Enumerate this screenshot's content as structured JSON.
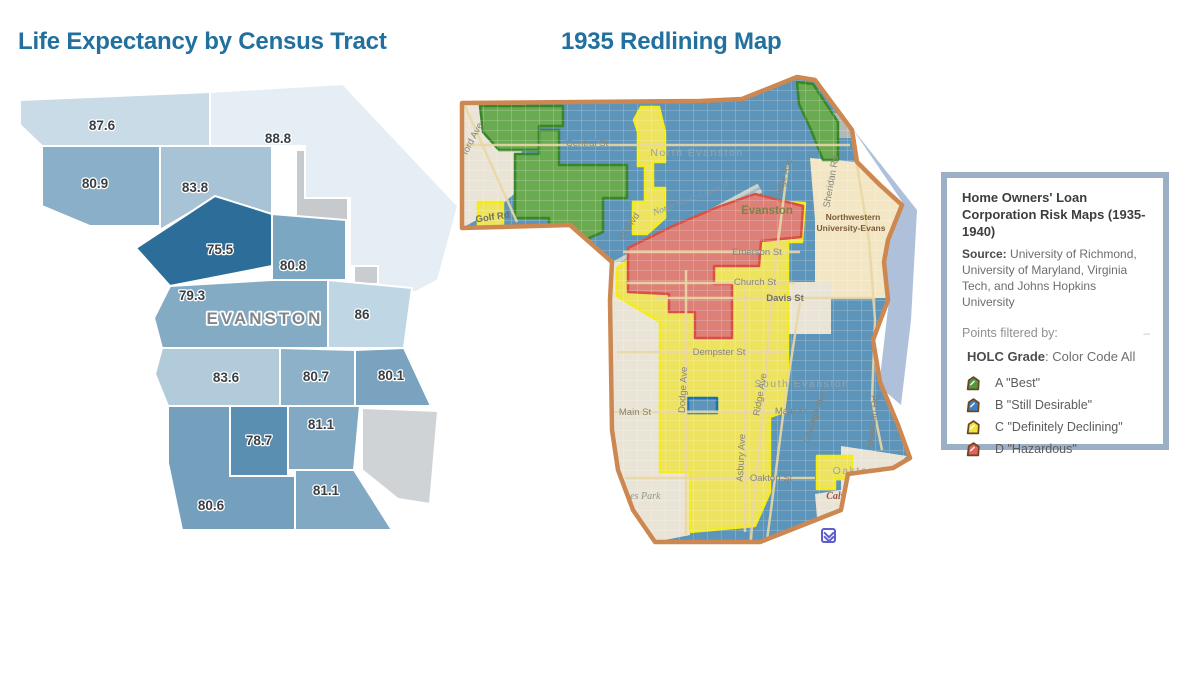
{
  "titles": {
    "left": "Life Expectancy by Census Tract",
    "right": "1935 Redlining Map",
    "color": "#21709e"
  },
  "life_map": {
    "city_label": "EVANSTON",
    "label_color": "#3a3f44",
    "tracts": [
      {
        "value": "87.6",
        "fill": "#c9dbe7",
        "points": "10,22 200,14 200,68 32,68 10,47",
        "lx": 92,
        "ly": 52
      },
      {
        "value": "88.8",
        "fill": "#e5eef4",
        "points": "200,14 333,6 448,128 428,202 406,214 368,214 368,188 340,188 340,120 295,120 295,68 200,68",
        "lx": 268,
        "ly": 65
      },
      {
        "value": "80.9",
        "fill": "#8aafc8",
        "points": "32,68 150,68 150,148 80,148 32,128",
        "lx": 85,
        "ly": 110
      },
      {
        "value": "83.8",
        "fill": "#a7c3d5",
        "points": "150,68 262,68 262,136 205,120 150,152",
        "lx": 185,
        "ly": 114
      },
      {
        "value": "75.5",
        "fill": "#2c6e99",
        "points": "126,170 205,118 262,136 262,188 160,208",
        "lx": 210,
        "ly": 176
      },
      {
        "value": "80.8",
        "fill": "#7ca7c2",
        "points": "262,136 336,142 336,202 262,202",
        "lx": 283,
        "ly": 192
      },
      {
        "value": "79.3",
        "fill": "#84abc4",
        "points": "160,208 262,202 318,202 318,270 152,270 144,240",
        "lx": 182,
        "ly": 222
      },
      {
        "value": "86",
        "fill": "#bfd7e4",
        "points": "318,202 402,210 394,270 318,270",
        "lx": 352,
        "ly": 241
      },
      {
        "value": "83.6",
        "fill": "#b2cbdb",
        "points": "152,270 270,270 270,328 158,328 145,296",
        "lx": 216,
        "ly": 304
      },
      {
        "value": "80.7",
        "fill": "#8db1c9",
        "points": "270,270 345,272 345,328 270,328",
        "lx": 306,
        "ly": 303
      },
      {
        "value": "80.1",
        "fill": "#79a3bf",
        "points": "345,272 394,270 421,328 345,328",
        "lx": 381,
        "ly": 302
      },
      {
        "value": "78.7",
        "fill": "#5a8fb2",
        "points": "220,328 278,328 278,398 220,398",
        "lx": 249,
        "ly": 367
      },
      {
        "value": "81.1",
        "fill": "#82a9c4",
        "points": "278,328 350,328 344,392 278,392",
        "lx": 311,
        "ly": 351
      },
      {
        "value": "80.6",
        "fill": "#74a0bd",
        "points": "158,328 220,328 220,398 285,398 285,452 172,452 158,385",
        "lx": 201,
        "ly": 432
      },
      {
        "value": "81.1",
        "fill": "#82a9c4",
        "points": "285,392 344,392 382,452 285,452",
        "lx": 316,
        "ly": 417
      }
    ],
    "unlabeled": [
      {
        "name": "campus-gray-west",
        "fill": "#c6cacd",
        "points": "286,72 338,72 338,176 286,176"
      },
      {
        "name": "campus-gray-east",
        "fill": "#c9cdd0",
        "points": "344,98 416,100 421,180 402,206 344,206"
      },
      {
        "name": "southeast-gray",
        "fill": "#d0d3d5",
        "points": "352,330 428,333 420,426 388,421 352,392"
      }
    ]
  },
  "redlining_map": {
    "boundary_points": "7,33 245,31 287,29 342,7 360,10 397,60 402,92 425,115 447,135 433,170 429,192 433,230 418,270 425,312 443,355 455,388 438,398 393,404 386,440 305,472 200,472 178,440 163,400 157,360 155,230 157,192 115,155 7,158",
    "boundary_color": "#cd8750",
    "base_fill": "#5d94ba",
    "lake": {
      "fill": "#aec0da",
      "points": "397,58 462,140 456,250 446,335 424,316 434,230 430,192 434,170 448,133"
    },
    "channel": {
      "color": "#c9d2c6",
      "line": "#9fb6c9",
      "points": "160,196 305,118"
    },
    "grade_styles": {
      "A": {
        "fill": "#6aaa50",
        "stroke": "#37862a"
      },
      "B": {
        "fill": "#5d94ba",
        "stroke": "#1d6fb5"
      },
      "C": {
        "fill": "#ede35e",
        "stroke": "#f5ec16"
      },
      "D": {
        "fill": "#dc8078",
        "stroke": "#da4f44"
      },
      "unzoned": {
        "fill": "#e9e4d6",
        "stroke": "none"
      },
      "campus": {
        "fill": "#f3e6c4",
        "stroke": "none"
      },
      "gray": {
        "fill": "#b3bab6",
        "stroke": "none"
      }
    },
    "regions": [
      {
        "name": "unzoned-northwest",
        "grade": "unzoned",
        "points": "7,33 70,33 64,120 40,140 7,158"
      },
      {
        "name": "unzoned-west-strip",
        "grade": "unzoned",
        "points": "155,230 157,192 205,192 205,402 235,402 235,465 200,472 178,440 163,400 157,360"
      },
      {
        "name": "northwestern-campus",
        "grade": "campus",
        "points": "355,88 402,92 425,115 447,135 433,170 429,192 433,228 360,228 360,150"
      },
      {
        "name": "downtown-block",
        "grade": "unzoned",
        "points": "333,212 376,212 376,264 333,264"
      },
      {
        "name": "calvary-cemetery-area",
        "grade": "unzoned",
        "points": "386,376 452,386 437,399 393,405 387,438 362,448 360,424 386,420"
      },
      {
        "name": "gray-block",
        "grade": "gray",
        "points": "365,43 397,43 397,68 365,68"
      },
      {
        "name": "grade-A-northwest-1",
        "grade": "A",
        "points": "25,36 108,36 108,56 84,56 84,80 44,80 28,62"
      },
      {
        "name": "grade-A-northwest-2",
        "grade": "A",
        "points": "60,84 84,84 84,60 104,60 104,95 172,95 172,128 148,128 148,162 118,175 94,175 94,148 60,148"
      },
      {
        "name": "grade-A-northeast",
        "grade": "A",
        "points": "342,12 358,14 383,52 383,90 368,90 356,60 344,34"
      },
      {
        "name": "grade-C-greenbay-strip",
        "grade": "C",
        "points": "186,37 204,37 210,62 210,92 198,92 198,118 210,118 210,148 192,164 178,164 178,132 190,132 190,96 183,96 183,62 179,50"
      },
      {
        "name": "grade-C-west-pocket",
        "grade": "C",
        "points": "23,132 48,132 48,180 23,180"
      },
      {
        "name": "grade-C-central-south",
        "grade": "C",
        "points": "162,198 205,170 250,143 296,130 350,133 347,172 333,172 333,310 329,342 315,347 315,422 300,456 235,462 235,402 205,402 205,252 162,226"
      },
      {
        "name": "grade-C-oakton-pocket",
        "grade": "C",
        "points": "362,386 397,386 397,409 380,409 380,419 362,419"
      },
      {
        "name": "grade-D-hazardous-core",
        "grade": "D",
        "points": "173,178 218,156 263,137 300,124 348,136 346,167 306,171 304,196 259,196 259,214 277,214 277,268 240,268 240,242 214,242 214,224 173,222"
      },
      {
        "name": "grade-B-main-st-notch",
        "grade": "B",
        "points": "233,328 262,328 262,343 233,343"
      }
    ],
    "roads": [
      {
        "name": "Crawford Ave",
        "pts": "10,36 62,152"
      },
      {
        "name": "Central St",
        "pts": "10,75 395,75"
      },
      {
        "name": "Emerson St",
        "pts": "168,182 345,182"
      },
      {
        "name": "Church St",
        "pts": "172,213 340,213"
      },
      {
        "name": "Davis St",
        "pts": "200,228 420,228"
      },
      {
        "name": "Dempster St",
        "pts": "162,282 330,282"
      },
      {
        "name": "Main St",
        "pts": "157,342 332,342"
      },
      {
        "name": "Oakton St",
        "pts": "170,408 360,408"
      },
      {
        "name": "Ridge Ave",
        "pts": "333,95 322,180 315,250 308,340 298,440 296,470"
      },
      {
        "name": "Dodge Ave",
        "pts": "231,200 231,466"
      },
      {
        "name": "Asbury Ave",
        "pts": "290,215 290,462"
      },
      {
        "name": "Chicago Ave",
        "pts": "345,232 330,330 316,440 312,470"
      },
      {
        "name": "Sheridan Rd",
        "pts": "402,95 414,170 420,250 417,330 427,380"
      }
    ],
    "labels": [
      {
        "text": "ford Ave",
        "x": 20,
        "y": 70,
        "rot": -62,
        "cls": "st"
      },
      {
        "text": "Golf Rd",
        "x": 38,
        "y": 150,
        "rot": -8,
        "cls": "stDark"
      },
      {
        "text": "Central St",
        "x": 132,
        "y": 76,
        "rot": 0,
        "cls": "st"
      },
      {
        "text": "North Evanston",
        "x": 242,
        "y": 86,
        "rot": 0,
        "cls": "place"
      },
      {
        "text": "North Shore Channel",
        "x": 237,
        "y": 131,
        "rot": -21,
        "cls": "water"
      },
      {
        "text": "ck Blvd",
        "x": 176,
        "y": 158,
        "rot": -55,
        "cls": "st"
      },
      {
        "text": "Evanston",
        "x": 312,
        "y": 144,
        "rot": 0,
        "cls": "evanston"
      },
      {
        "text": "Ridge Ave",
        "x": 331,
        "y": 110,
        "rot": -72,
        "cls": "st"
      },
      {
        "text": "Sheridan Rd",
        "x": 379,
        "y": 112,
        "rot": -80,
        "cls": "st"
      },
      {
        "text": "Northwestern",
        "x": 398,
        "y": 150,
        "rot": 0,
        "cls": "nw"
      },
      {
        "text": "University-Evans",
        "x": 396,
        "y": 161,
        "rot": 0,
        "cls": "nw"
      },
      {
        "text": "Emerson St",
        "x": 302,
        "y": 185,
        "rot": 0,
        "cls": "st"
      },
      {
        "text": "Church St",
        "x": 300,
        "y": 215,
        "rot": 0,
        "cls": "st"
      },
      {
        "text": "Davis St",
        "x": 330,
        "y": 231,
        "rot": 0,
        "cls": "stDark"
      },
      {
        "text": "Dempster St",
        "x": 264,
        "y": 285,
        "rot": 0,
        "cls": "st"
      },
      {
        "text": "Dodge Ave",
        "x": 231,
        "y": 320,
        "rot": -87,
        "cls": "st"
      },
      {
        "text": "Ridge Ave",
        "x": 308,
        "y": 325,
        "rot": -80,
        "cls": "st"
      },
      {
        "text": "South Evanston",
        "x": 347,
        "y": 317,
        "rot": 0,
        "cls": "place"
      },
      {
        "text": "Main St",
        "x": 180,
        "y": 345,
        "rot": 0,
        "cls": "st"
      },
      {
        "text": "Main St",
        "x": 336,
        "y": 344,
        "rot": 0,
        "cls": "st"
      },
      {
        "text": "Chicago Ave",
        "x": 362,
        "y": 348,
        "rot": -72,
        "cls": "st"
      },
      {
        "text": "Sheridan Rd",
        "x": 421,
        "y": 352,
        "rot": -85,
        "cls": "st"
      },
      {
        "text": "Asbury Ave",
        "x": 289,
        "y": 388,
        "rot": -87,
        "cls": "st"
      },
      {
        "text": "Oakton St",
        "x": 316,
        "y": 411,
        "rot": 0,
        "cls": "st"
      },
      {
        "text": "Oakton",
        "x": 399,
        "y": 404,
        "rot": 0,
        "cls": "place"
      },
      {
        "text": "James Park",
        "x": 182,
        "y": 429,
        "rot": 0,
        "cls": "park"
      },
      {
        "text": "Calvary Cemetery",
        "x": 408,
        "y": 429,
        "rot": 0,
        "cls": "cem"
      }
    ]
  },
  "legend_panel": {
    "title": "Home Owners' Loan Corporation Risk Maps (1935-1940)",
    "source_label": "Source:",
    "source_text": " University of Richmond, University of Maryland, Virginia Tech, and Johns Hopkins University",
    "filter_label": "Points filtered by:",
    "collapse_dash": "–",
    "grade_label": "HOLC Grade",
    "grade_value": ": Color Code All",
    "icon_outline": "#6a4423",
    "border_color": "#9cb0c5",
    "items": [
      {
        "grade": "A",
        "label": "A \"Best\"",
        "color": "#4e9a3e"
      },
      {
        "grade": "B",
        "label": "B \"Still Desirable\"",
        "color": "#3e7fc1"
      },
      {
        "grade": "C",
        "label": "C \"Definitely Declining\"",
        "color": "#f2e33c"
      },
      {
        "grade": "D",
        "label": "D \"Hazardous\"",
        "color": "#e2635c"
      }
    ]
  }
}
